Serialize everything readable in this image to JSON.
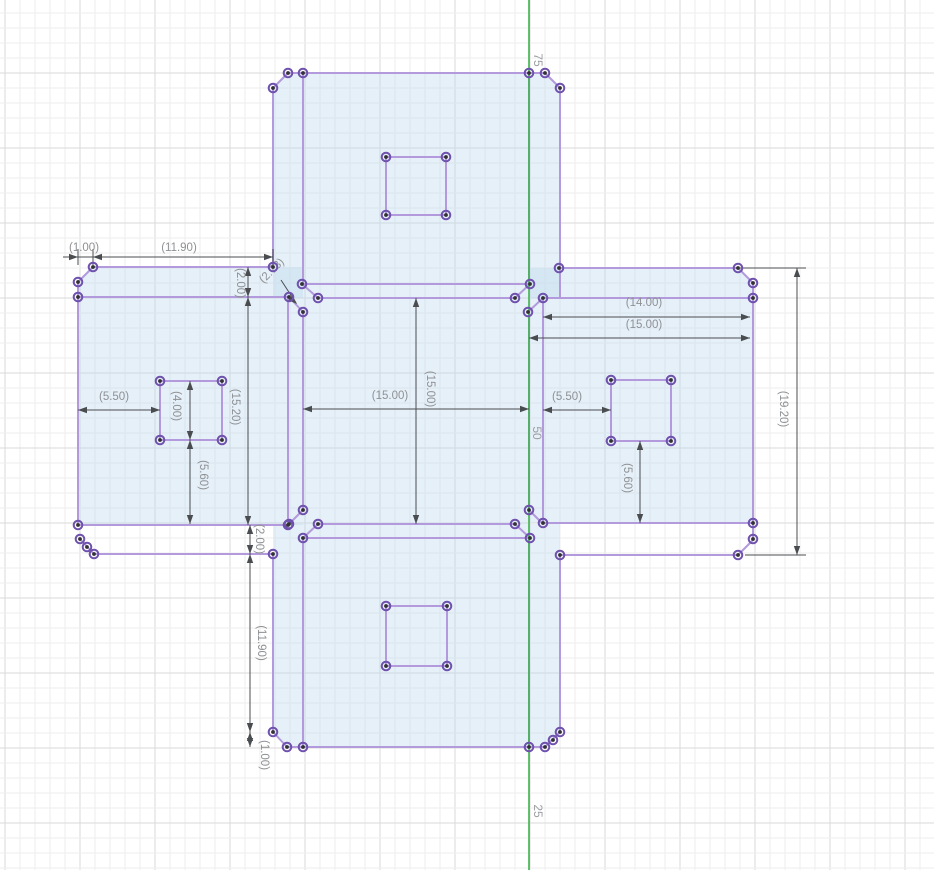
{
  "app": {
    "name": "cad-sketch-viewport"
  },
  "canvas": {
    "width": 934,
    "height": 870,
    "background": "#ffffff"
  },
  "grid": {
    "minor_spacing": 15,
    "major_spacing": 75,
    "offset_x": 5,
    "offset_y": 13,
    "minor_color": "#ededed",
    "major_color": "#dadada"
  },
  "axis": {
    "x": 529,
    "color": "#3eb34b",
    "labels": [
      {
        "text": "75",
        "x": 537,
        "y": 60,
        "rot": 90
      },
      {
        "text": "50",
        "x": 536,
        "y": 433,
        "rot": 90
      },
      {
        "text": "25",
        "x": 537,
        "y": 811,
        "rot": 90
      }
    ],
    "label_color": "#9b9ea1",
    "label_size": 12
  },
  "sketch": {
    "stroke_color": "#b29add",
    "stroke_width": 2,
    "fill_color": "#bcd8ec",
    "fill_opacity": 0.38,
    "point_ring_color": "#6f51ae",
    "point_core_color": "#323232",
    "fills": [
      [
        [
          273,
          88
        ],
        [
          288,
          73
        ],
        [
          545,
          73
        ],
        [
          560,
          88
        ],
        [
          560,
          298
        ],
        [
          273,
          298
        ]
      ],
      [
        [
          78,
          282
        ],
        [
          93,
          267
        ],
        [
          303,
          267
        ],
        [
          303,
          525
        ],
        [
          78,
          525
        ]
      ],
      [
        [
          529,
          268
        ],
        [
          738,
          268
        ],
        [
          753,
          283
        ],
        [
          753,
          523
        ],
        [
          529,
          523
        ]
      ],
      [
        [
          303,
          298
        ],
        [
          529,
          298
        ],
        [
          529,
          524
        ],
        [
          303,
          524
        ]
      ],
      [
        [
          273,
          524
        ],
        [
          560,
          524
        ],
        [
          560,
          732
        ],
        [
          545,
          747
        ],
        [
          287,
          747
        ],
        [
          273,
          732
        ]
      ]
    ],
    "edges": [
      [
        288,
        73,
        545,
        73
      ],
      [
        288,
        73,
        273,
        88
      ],
      [
        545,
        73,
        560,
        88
      ],
      [
        273,
        88,
        273,
        267
      ],
      [
        560,
        88,
        560,
        298
      ],
      [
        303,
        73,
        303,
        284
      ],
      [
        529,
        73,
        529,
        284
      ],
      [
        302,
        284,
        530,
        284
      ],
      [
        386,
        157,
        446,
        157
      ],
      [
        446,
        157,
        446,
        215
      ],
      [
        446,
        215,
        386,
        215
      ],
      [
        386,
        215,
        386,
        157
      ],
      [
        302,
        284,
        318,
        298
      ],
      [
        289,
        297,
        303,
        312
      ],
      [
        530,
        284,
        515,
        298
      ],
      [
        528,
        312,
        543,
        298
      ],
      [
        93,
        267,
        273,
        267
      ],
      [
        93,
        267,
        78,
        282
      ],
      [
        78,
        282,
        78,
        525
      ],
      [
        78,
        297,
        289,
        297
      ],
      [
        288,
        297,
        288,
        525
      ],
      [
        78,
        525,
        288,
        525
      ],
      [
        94,
        554,
        273,
        554
      ],
      [
        80,
        539,
        94,
        554
      ],
      [
        160,
        381,
        222,
        381
      ],
      [
        222,
        381,
        222,
        440
      ],
      [
        222,
        440,
        160,
        440
      ],
      [
        160,
        440,
        160,
        381
      ],
      [
        318,
        298,
        515,
        298
      ],
      [
        303,
        312,
        303,
        510
      ],
      [
        529,
        312,
        529,
        510
      ],
      [
        318,
        524,
        515,
        524
      ],
      [
        303,
        510,
        289,
        524
      ],
      [
        303,
        538,
        318,
        524
      ],
      [
        529,
        510,
        543,
        524
      ],
      [
        530,
        538,
        515,
        524
      ],
      [
        559,
        268,
        738,
        268
      ],
      [
        738,
        268,
        753,
        283
      ],
      [
        753,
        283,
        753,
        539
      ],
      [
        543,
        298,
        753,
        298
      ],
      [
        543,
        298,
        543,
        523
      ],
      [
        543,
        523,
        753,
        523
      ],
      [
        560,
        555,
        738,
        555
      ],
      [
        738,
        555,
        753,
        540
      ],
      [
        611,
        380,
        671,
        380
      ],
      [
        671,
        380,
        671,
        441
      ],
      [
        671,
        441,
        611,
        441
      ],
      [
        611,
        441,
        611,
        380
      ],
      [
        287,
        747,
        545,
        747
      ],
      [
        273,
        732,
        287,
        747
      ],
      [
        560,
        732,
        545,
        747
      ],
      [
        273,
        554,
        273,
        732
      ],
      [
        560,
        555,
        560,
        732
      ],
      [
        302,
        538,
        530,
        538
      ],
      [
        303,
        538,
        303,
        747
      ],
      [
        529,
        538,
        529,
        747
      ],
      [
        386,
        606,
        447,
        606
      ],
      [
        447,
        606,
        447,
        666
      ],
      [
        447,
        666,
        386,
        666
      ],
      [
        386,
        666,
        386,
        606
      ]
    ],
    "points": [
      [
        288,
        73
      ],
      [
        303,
        73
      ],
      [
        529,
        73
      ],
      [
        545,
        73
      ],
      [
        273,
        88
      ],
      [
        560,
        88
      ],
      [
        386,
        157
      ],
      [
        446,
        157
      ],
      [
        386,
        215
      ],
      [
        446,
        215
      ],
      [
        273,
        267
      ],
      [
        93,
        267
      ],
      [
        78,
        282
      ],
      [
        78,
        297
      ],
      [
        289,
        297
      ],
      [
        302,
        284
      ],
      [
        303,
        312
      ],
      [
        318,
        298
      ],
      [
        559,
        268
      ],
      [
        530,
        284
      ],
      [
        515,
        298
      ],
      [
        528,
        312
      ],
      [
        543,
        298
      ],
      [
        738,
        268
      ],
      [
        753,
        283
      ],
      [
        753,
        298
      ],
      [
        543,
        523
      ],
      [
        753,
        523
      ],
      [
        753,
        539
      ],
      [
        738,
        555
      ],
      [
        560,
        555
      ],
      [
        611,
        380
      ],
      [
        671,
        380
      ],
      [
        611,
        441
      ],
      [
        671,
        441
      ],
      [
        160,
        381
      ],
      [
        222,
        381
      ],
      [
        160,
        440
      ],
      [
        222,
        440
      ],
      [
        78,
        525
      ],
      [
        80,
        539
      ],
      [
        87,
        547
      ],
      [
        94,
        554
      ],
      [
        273,
        554
      ],
      [
        288,
        525
      ],
      [
        303,
        510
      ],
      [
        289,
        524
      ],
      [
        318,
        524
      ],
      [
        303,
        538
      ],
      [
        529,
        510
      ],
      [
        515,
        524
      ],
      [
        530,
        538
      ],
      [
        273,
        732
      ],
      [
        287,
        747
      ],
      [
        303,
        747
      ],
      [
        529,
        747
      ],
      [
        545,
        747
      ],
      [
        553,
        740
      ],
      [
        560,
        732
      ],
      [
        386,
        606
      ],
      [
        447,
        606
      ],
      [
        386,
        666
      ],
      [
        447,
        666
      ]
    ]
  },
  "dimensions": {
    "line_color": "#4a4d50",
    "text_color": "#8e9194",
    "font_size": 11.5,
    "labels": [
      {
        "text": "(1.00)",
        "x": 84,
        "y": 248,
        "rot": 0
      },
      {
        "text": "(11.90)",
        "x": 179,
        "y": 248,
        "rot": 0
      },
      {
        "text": "(2.00)",
        "x": 240,
        "y": 283,
        "rot": 90
      },
      {
        "text": "(2.73)",
        "x": 272,
        "y": 271,
        "rot": -45
      },
      {
        "text": "(15.20)",
        "x": 235,
        "y": 407,
        "rot": 90
      },
      {
        "text": "(5.50)",
        "x": 114,
        "y": 397,
        "rot": 0
      },
      {
        "text": "(4.00)",
        "x": 176,
        "y": 406,
        "rot": 90
      },
      {
        "text": "(5.60)",
        "x": 203,
        "y": 475,
        "rot": 90
      },
      {
        "text": "(15.00)",
        "x": 390,
        "y": 396,
        "rot": 0
      },
      {
        "text": "(15.00)",
        "x": 430,
        "y": 389,
        "rot": 90
      },
      {
        "text": "(2.00)",
        "x": 259,
        "y": 539,
        "rot": 90
      },
      {
        "text": "(11.90)",
        "x": 261,
        "y": 643,
        "rot": 90
      },
      {
        "text": "(1.00)",
        "x": 264,
        "y": 755,
        "rot": 90
      },
      {
        "text": "(14.00)",
        "x": 644,
        "y": 303,
        "rot": 0
      },
      {
        "text": "(15.00)",
        "x": 644,
        "y": 325,
        "rot": 0
      },
      {
        "text": "(5.50)",
        "x": 567,
        "y": 397,
        "rot": 0
      },
      {
        "text": "(5.60)",
        "x": 627,
        "y": 478,
        "rot": 90
      },
      {
        "text": "(19.20)",
        "x": 783,
        "y": 409,
        "rot": 90
      }
    ],
    "lines": [
      [
        63,
        257,
        273,
        257
      ],
      [
        78,
        249,
        78,
        265
      ],
      [
        93,
        249,
        93,
        265
      ],
      [
        273,
        249,
        273,
        265
      ],
      [
        248,
        267,
        248,
        297
      ],
      [
        248,
        297,
        248,
        525
      ],
      [
        281,
        280,
        296,
        303
      ],
      [
        78,
        410,
        160,
        410
      ],
      [
        190,
        381,
        190,
        440
      ],
      [
        190,
        440,
        190,
        524
      ],
      [
        303,
        409,
        529,
        409
      ],
      [
        416,
        298,
        416,
        524
      ],
      [
        250,
        525,
        250,
        554
      ],
      [
        250,
        554,
        250,
        732
      ],
      [
        250,
        732,
        250,
        747
      ],
      [
        543,
        317,
        750,
        317
      ],
      [
        529,
        338,
        750,
        338
      ],
      [
        543,
        410,
        611,
        410
      ],
      [
        640,
        441,
        640,
        523
      ],
      [
        797,
        268,
        797,
        555
      ],
      [
        740,
        268,
        806,
        268
      ],
      [
        745,
        555,
        806,
        555
      ]
    ],
    "arrows": [
      [
        78,
        257,
        0
      ],
      [
        93,
        257,
        180
      ],
      [
        273,
        257,
        0
      ],
      [
        248,
        267,
        -90
      ],
      [
        248,
        297,
        90
      ],
      [
        248,
        297,
        -90
      ],
      [
        248,
        525,
        90
      ],
      [
        297,
        304,
        43
      ],
      [
        78,
        410,
        180
      ],
      [
        160,
        410,
        0
      ],
      [
        190,
        381,
        -90
      ],
      [
        190,
        440,
        90
      ],
      [
        190,
        440,
        -90
      ],
      [
        190,
        524,
        90
      ],
      [
        303,
        409,
        180
      ],
      [
        529,
        409,
        0
      ],
      [
        416,
        298,
        -90
      ],
      [
        416,
        524,
        90
      ],
      [
        250,
        525,
        -90
      ],
      [
        250,
        554,
        90
      ],
      [
        250,
        554,
        -90
      ],
      [
        250,
        732,
        90
      ],
      [
        250,
        732,
        -90
      ],
      [
        250,
        747,
        90
      ],
      [
        543,
        317,
        180
      ],
      [
        750,
        317,
        0
      ],
      [
        529,
        338,
        180
      ],
      [
        750,
        338,
        0
      ],
      [
        543,
        410,
        180
      ],
      [
        611,
        410,
        0
      ],
      [
        640,
        441,
        -90
      ],
      [
        640,
        523,
        90
      ],
      [
        797,
        268,
        -90
      ],
      [
        797,
        555,
        90
      ]
    ]
  }
}
